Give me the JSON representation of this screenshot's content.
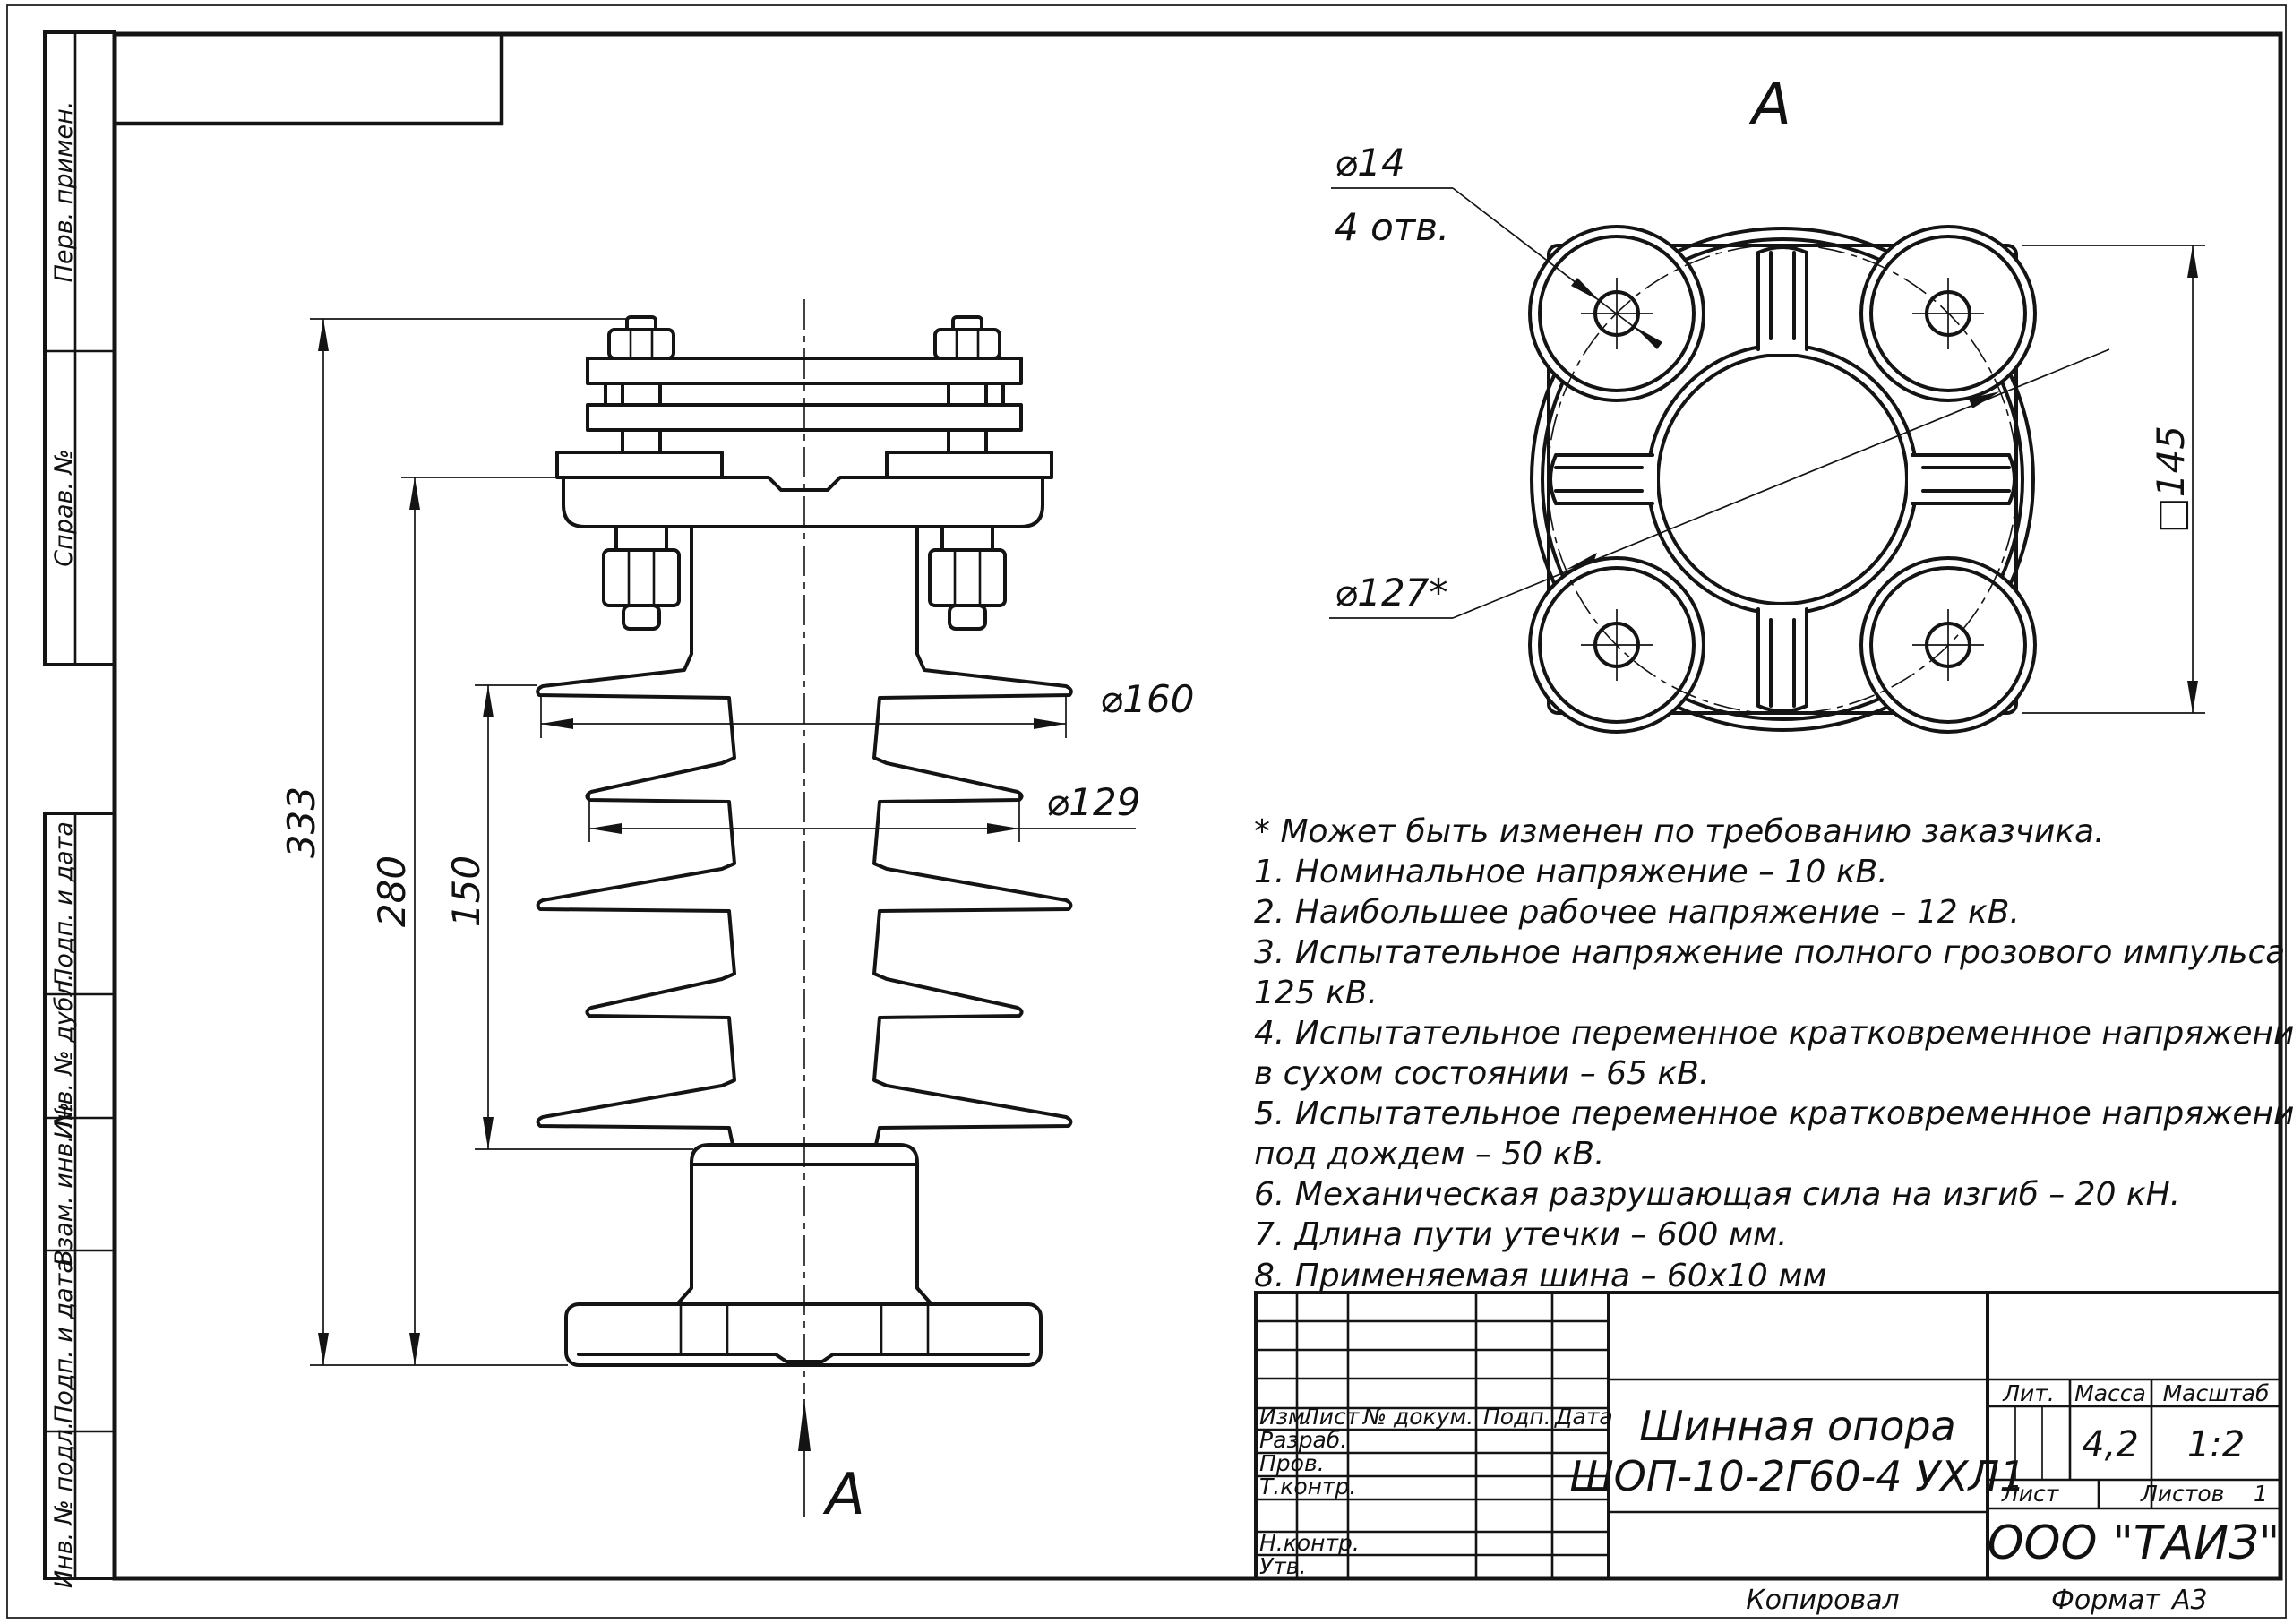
{
  "drawing": {
    "title_line1": "Шинная опора",
    "title_line2": "ШОП-10-2Г60-4 УХЛ1",
    "company": "ООО \"ТАИЗ\"",
    "mass_value": "4,2",
    "scale_value": "1:2",
    "sheets_value": "1",
    "copied_label": "Копировал",
    "format_label": "Формат",
    "format_value": "А3"
  },
  "title_block": {
    "lit_label": "Лит.",
    "mass_label": "Масса",
    "scale_label": "Масштаб",
    "sheet_label": "Лист",
    "sheets_label": "Листов",
    "header": {
      "izm": "Изм.",
      "list": "Лист",
      "doc": "№ докум.",
      "podp": "Подп.",
      "data": "Дата"
    },
    "rows": {
      "razrab": "Разраб.",
      "prov": "Пров.",
      "tkontr": "Т.контр.",
      "nkontr": "Н.контр.",
      "utv": "Утв."
    }
  },
  "side_strips": {
    "perv": "Перв. примен.",
    "sprav": "Справ. №",
    "podp1": "Подп. и дата",
    "inv_dubl": "Инв. № дубл.",
    "vzam": "Взам. инв. №",
    "podp2": "Подп. и дата",
    "inv_podl": "Инв. № подл."
  },
  "view_labels": {
    "top_view_title": "А",
    "section_arrow": "А"
  },
  "dimensions": {
    "height_overall": "333",
    "height_body": "280",
    "height_insulation": "150",
    "dia_big_shed": "⌀160",
    "dia_small_shed": "⌀129",
    "hole_dia": "⌀14",
    "hole_count": "4 отв.",
    "bolt_circle": "⌀127*",
    "square_size": "□145"
  },
  "notes": {
    "lines": [
      "* Может быть изменен по требованию заказчика.",
      "1. Номинальное напряжение – 10 кВ.",
      "2. Наибольшее рабочее напряжение – 12 кВ.",
      "3. Испытательное напряжение полного грозового импульса –",
      "125 кВ.",
      "4. Испытательное переменное кратковременное напряжение",
      "в сухом состоянии – 65 кВ.",
      "5. Испытательное переменное кратковременное напряжение",
      "под дождем – 50 кВ.",
      "6. Механическая разрушающая сила на изгиб – 20 кН.",
      "7. Длина пути утечки – 600 мм.",
      "8. Применяемая шина – 60x10 мм"
    ]
  }
}
